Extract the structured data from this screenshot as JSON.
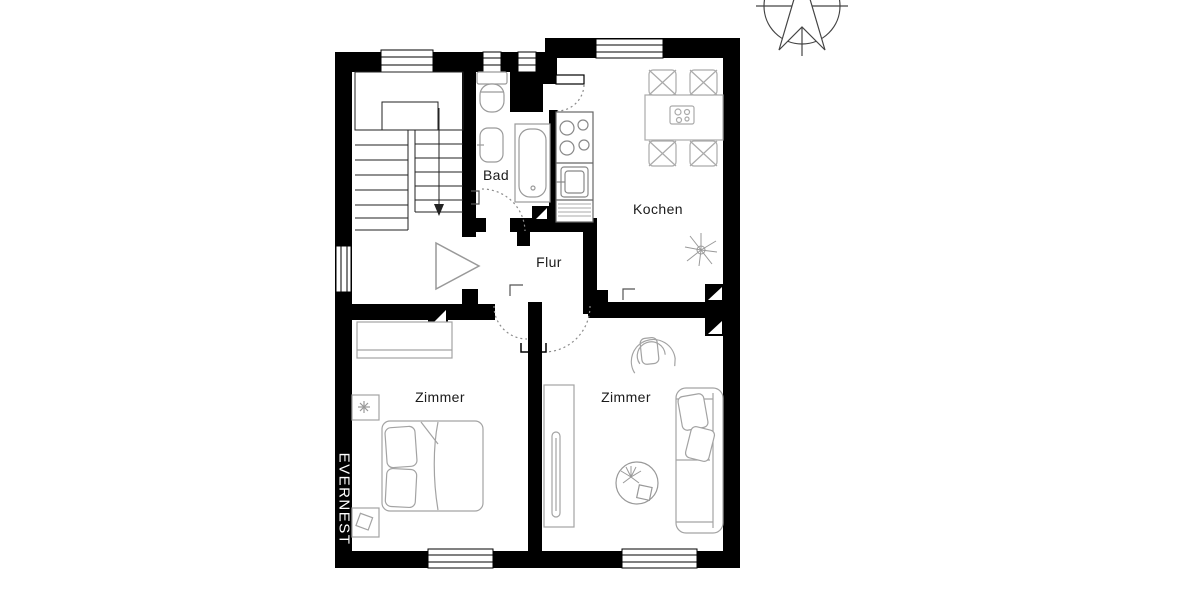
{
  "brand": {
    "name": "EVERNEST"
  },
  "rooms": {
    "bad": {
      "label": "Bad"
    },
    "kochen": {
      "label": "Kochen"
    },
    "flur": {
      "label": "Flur"
    },
    "zimmer_left": {
      "label": "Zimmer"
    },
    "zimmer_right": {
      "label": "Zimmer"
    }
  },
  "fixtures": {
    "stairwell": [
      "staircase",
      "down-arrow"
    ],
    "bad": [
      "toilet",
      "washbasin",
      "bathtub"
    ],
    "kochen": [
      "stove",
      "kitchen-sink",
      "counter",
      "dining-table",
      "four-chairs",
      "plant"
    ],
    "flur": [
      "entrance-arrow",
      "door-swing-arcs"
    ],
    "zimmer_left": [
      "wardrobe",
      "double-bed",
      "two-nightstands",
      "flower"
    ],
    "zimmer_right": [
      "armchair",
      "wardrobe",
      "round-rug",
      "plant",
      "sofa"
    ]
  },
  "symbols": {
    "compass": "north-compass",
    "windows": 7,
    "door_markers": 4
  },
  "colors": {
    "wall": "#000000",
    "furniture_outline": "#a3a3a3",
    "stair_line": "#222222",
    "door_arc": "#8a8a8a",
    "label_text": "#1a1a1a",
    "brand_text": "#ffffff",
    "background": "#ffffff"
  }
}
